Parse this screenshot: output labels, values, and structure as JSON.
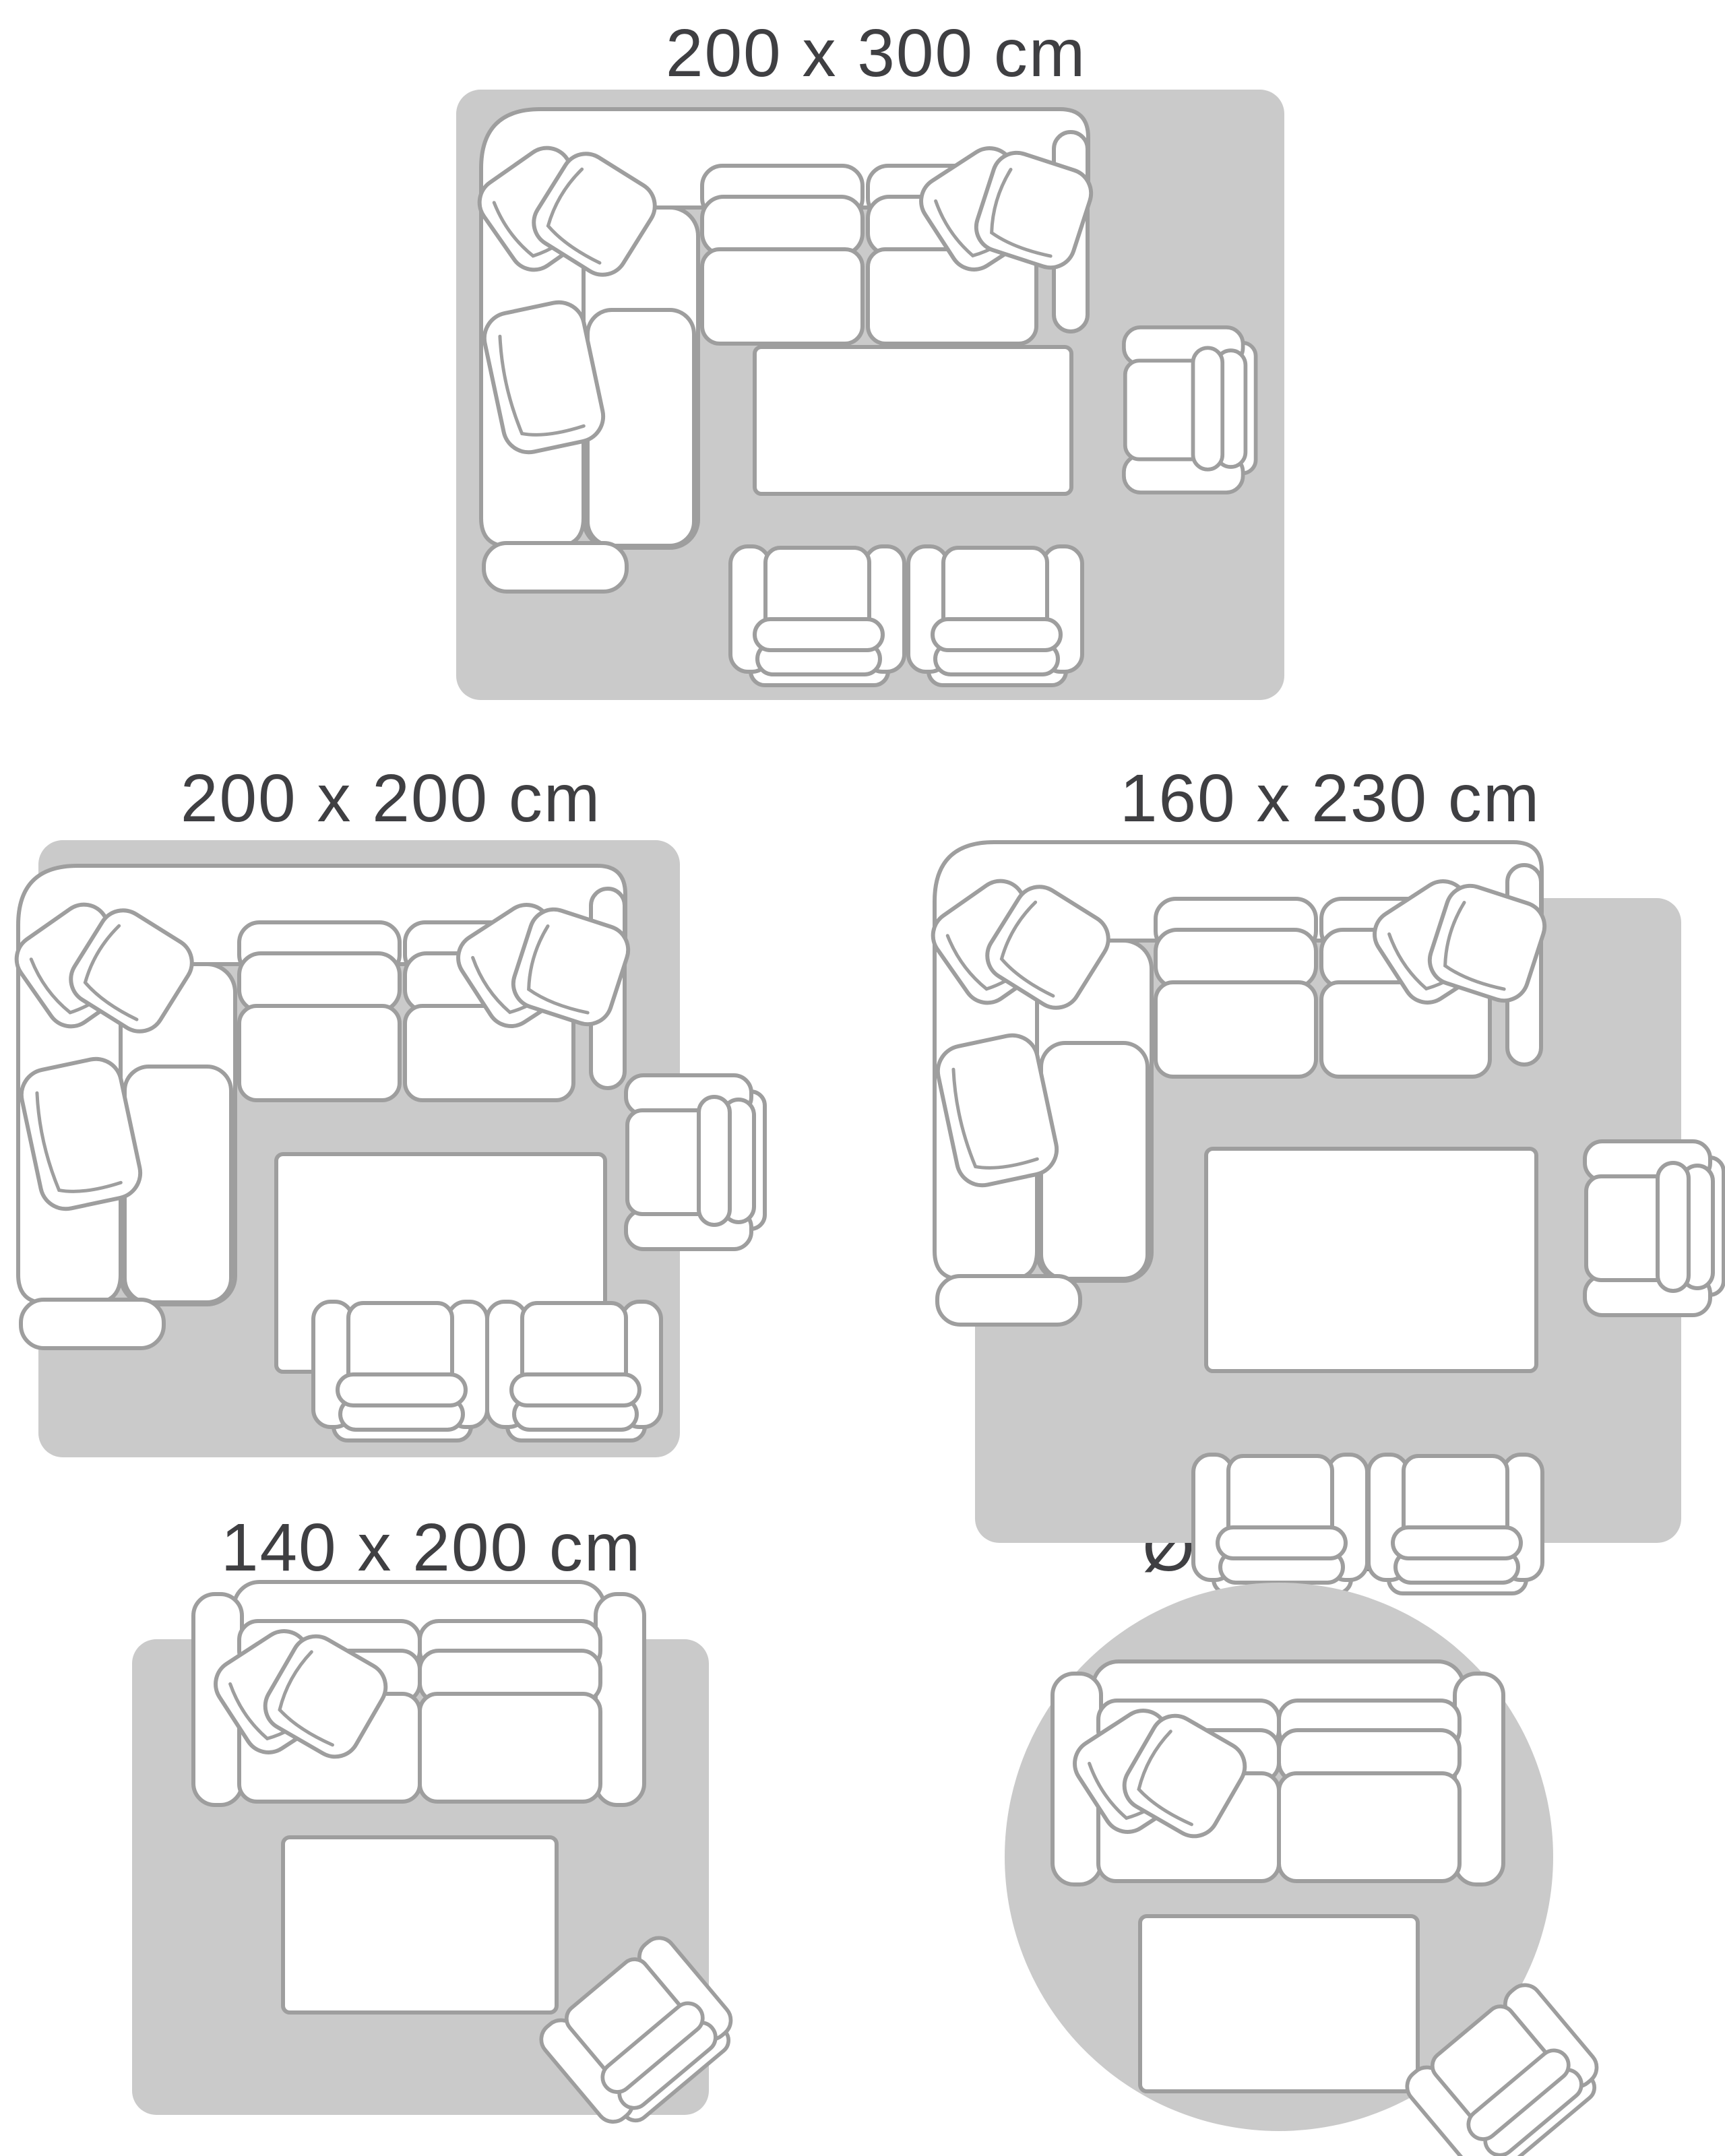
{
  "palette": {
    "background": "#ffffff",
    "rug_fill": "#cacaca",
    "furniture_fill": "#ffffff",
    "furniture_outline": "#9e9e9e",
    "label_color": "#3f3f42"
  },
  "diagrams": [
    {
      "id": "rug-200x300",
      "label": "200 x 300 cm",
      "rug_shape": "rectangle",
      "furniture": [
        "corner-sofa-with-chaise",
        "throw-cushions",
        "coffee-table",
        "side-armchair",
        "club-chair",
        "club-chair"
      ]
    },
    {
      "id": "rug-200x200",
      "label": "200 x 200 cm",
      "rug_shape": "square",
      "furniture": [
        "corner-sofa-with-chaise",
        "throw-cushions",
        "coffee-table",
        "side-armchair",
        "club-chair",
        "club-chair"
      ]
    },
    {
      "id": "rug-160x230",
      "label": "160 x 230 cm",
      "rug_shape": "rectangle",
      "furniture": [
        "corner-sofa-with-chaise",
        "throw-cushions",
        "coffee-table",
        "side-armchair",
        "club-chair",
        "club-chair"
      ]
    },
    {
      "id": "rug-140x200",
      "label": "140 x 200 cm",
      "rug_shape": "rectangle",
      "furniture": [
        "two-seater-sofa",
        "throw-cushions",
        "coffee-table",
        "tilted-armchair"
      ]
    },
    {
      "id": "rug-diameter-140",
      "label": "Ø 140 cm",
      "rug_shape": "circle",
      "furniture": [
        "two-seater-sofa",
        "throw-cushions",
        "coffee-table",
        "tilted-armchair"
      ]
    }
  ]
}
